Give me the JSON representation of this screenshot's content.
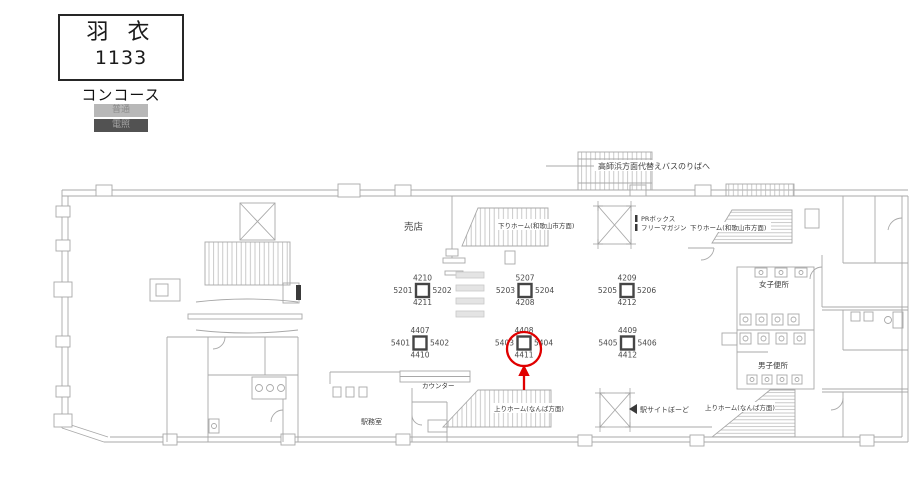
{
  "header": {
    "station_name": "羽 衣",
    "board_id": "1133",
    "area_label": "コンコース",
    "badges": [
      {
        "label": "普通"
      },
      {
        "label": "電照"
      }
    ]
  },
  "colors": {
    "badge_normal_bg": "#b8b8b8",
    "badge_normal_fg": "#8a8a8a",
    "badge_lit_bg": "#525252",
    "badge_lit_fg": "#a6a6a6",
    "plan_line": "#a8a8a8",
    "highlight": "#e00000"
  },
  "plan": {
    "labels": {
      "bus_exit": "高師浜方面代替えバスのりばへ",
      "shop": "売店",
      "down_platform_center": "下りホーム(和歌山市方面)",
      "pr_box_line1": "PRボックス",
      "pr_box_line2": "フリーマガジン",
      "down_platform_right": "下りホーム(和歌山市方面)",
      "womens_toilet": "女子便所",
      "mens_toilet": "男子便所",
      "counter": "カウンター",
      "station_office": "駅務室",
      "up_platform_center": "上りホーム(なんば方面)",
      "station_site_board": "駅サイトぼーど",
      "up_platform_right": "上りホーム(なんば方面)"
    },
    "ad_groups": [
      {
        "top": "4210",
        "left": "5201",
        "right": "5202",
        "bottom": "4211"
      },
      {
        "top": "5207",
        "left": "5203",
        "right": "5204",
        "bottom": "4208"
      },
      {
        "top": "4209",
        "left": "5205",
        "right": "5206",
        "bottom": "4212"
      },
      {
        "top": "4407",
        "left": "5401",
        "right": "5402",
        "bottom": "4410"
      },
      {
        "top": "4408",
        "left": "5403",
        "right": "5404",
        "bottom": "4411",
        "highlighted": true
      },
      {
        "top": "4409",
        "left": "5405",
        "right": "5406",
        "bottom": "4412"
      }
    ]
  }
}
